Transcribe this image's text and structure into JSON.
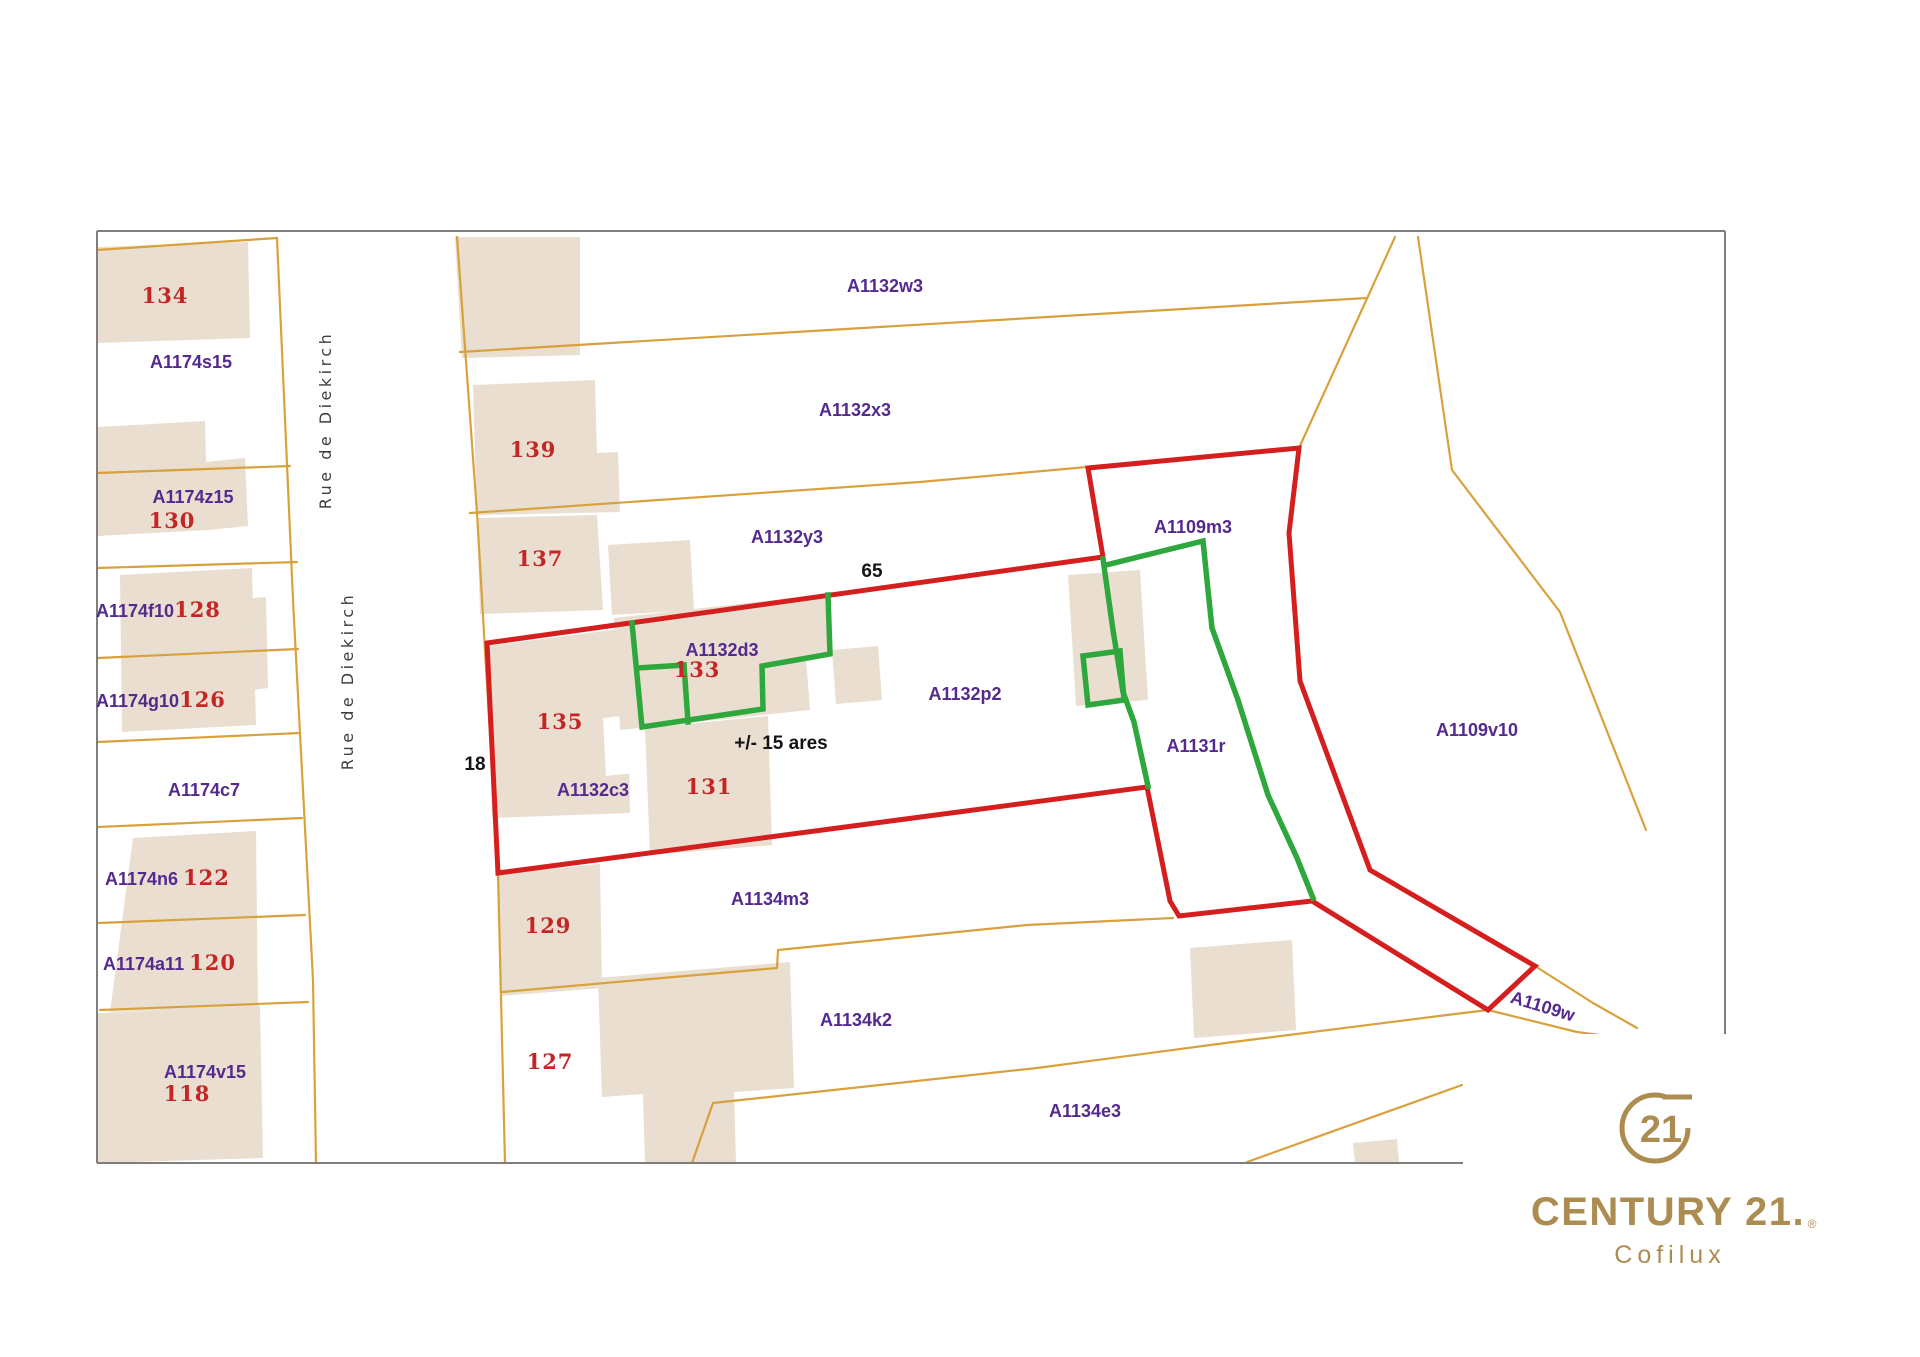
{
  "street": {
    "name_upper": "Rue de Diekirch",
    "name_lower": "Rue de Diekirch"
  },
  "parcels": {
    "a1174s15": "A1174s15",
    "a1174z15": "A1174z15",
    "a1174f10": "A1174f10",
    "a1174g10": "A1174g10",
    "a1174c7": "A1174c7",
    "a1174n6": "A1174n6 ",
    "a1174a11": "A1174a11 ",
    "a1174v15": "A1174v15",
    "a1132w3": "A1132w3",
    "a1132x3": "A1132x3",
    "a1132y3": "A1132y3",
    "a1132d3": "A1132d3",
    "a1132c3": "A1132c3",
    "a1132p2": "A1132p2",
    "a1109m3": "A1109m3",
    "a1131r": "A1131r",
    "a1109v10": "A1109v10",
    "a1109w": "A1109w",
    "a1134m3": "A1134m3",
    "a1134k2": "A1134k2",
    "a1134e3": "A1134e3"
  },
  "house_numbers": {
    "n134": "134",
    "n130": "130",
    "n128": "128",
    "n126": "126",
    "n122": "122",
    "n120": "120",
    "n118": "118",
    "n139": "139",
    "n137": "137",
    "n135": "135",
    "n133": "133",
    "n131": "131",
    "n129": "129",
    "n127": "127"
  },
  "measurements": {
    "top_length": "65",
    "left_length": "18",
    "area": "+/- 15 ares"
  },
  "logo": {
    "seal_number": "21",
    "brand": "CENTURY 21.",
    "registered": "®",
    "agency": "Cofilux"
  },
  "colors": {
    "boundary_orange": "#D8A13C",
    "highlight_red": "#D51F1F",
    "highlight_green": "#2EA83C",
    "building_fill": "#E9DED0",
    "parcel_label_purple": "#542A8E",
    "house_number_red": "#C42525",
    "annotation_black": "#141414",
    "logo_gold": "#AD8C51",
    "map_border_gray": "#7e7e7e"
  }
}
